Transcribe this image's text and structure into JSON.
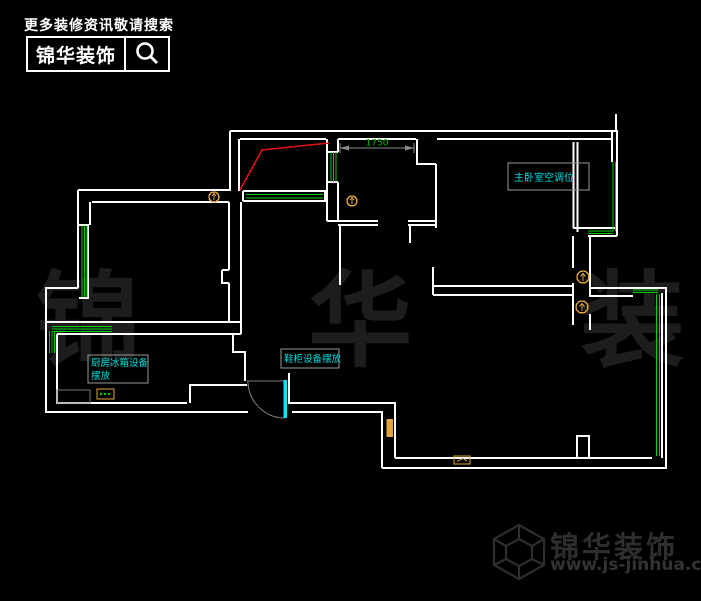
{
  "header": {
    "tagline": "更多装修资讯敬请搜索",
    "brand": "锦华装饰"
  },
  "watermark": {
    "text": "锦 华 装 饰"
  },
  "floorplan": {
    "dimension_label": "1750",
    "labels": {
      "master_ac": "主卧室空调位",
      "kitchen_fridge_line1": "厨房冰箱设备",
      "kitchen_fridge_line2": "摆放",
      "shoe_cabinet": "鞋柜设备摆放"
    },
    "colors": {
      "wall": "#ffffff",
      "window": "#00cc00",
      "door_leaf": "#00e5ff",
      "annotation_text": "#00dede",
      "symbol": "#e0a53c",
      "red_line": "#dd1111",
      "dimension_text": "#00bb00",
      "dim_gray": "#8a8a8a"
    }
  },
  "footer": {
    "brand": "锦华装饰",
    "website": "www.js-jinhua.com"
  }
}
